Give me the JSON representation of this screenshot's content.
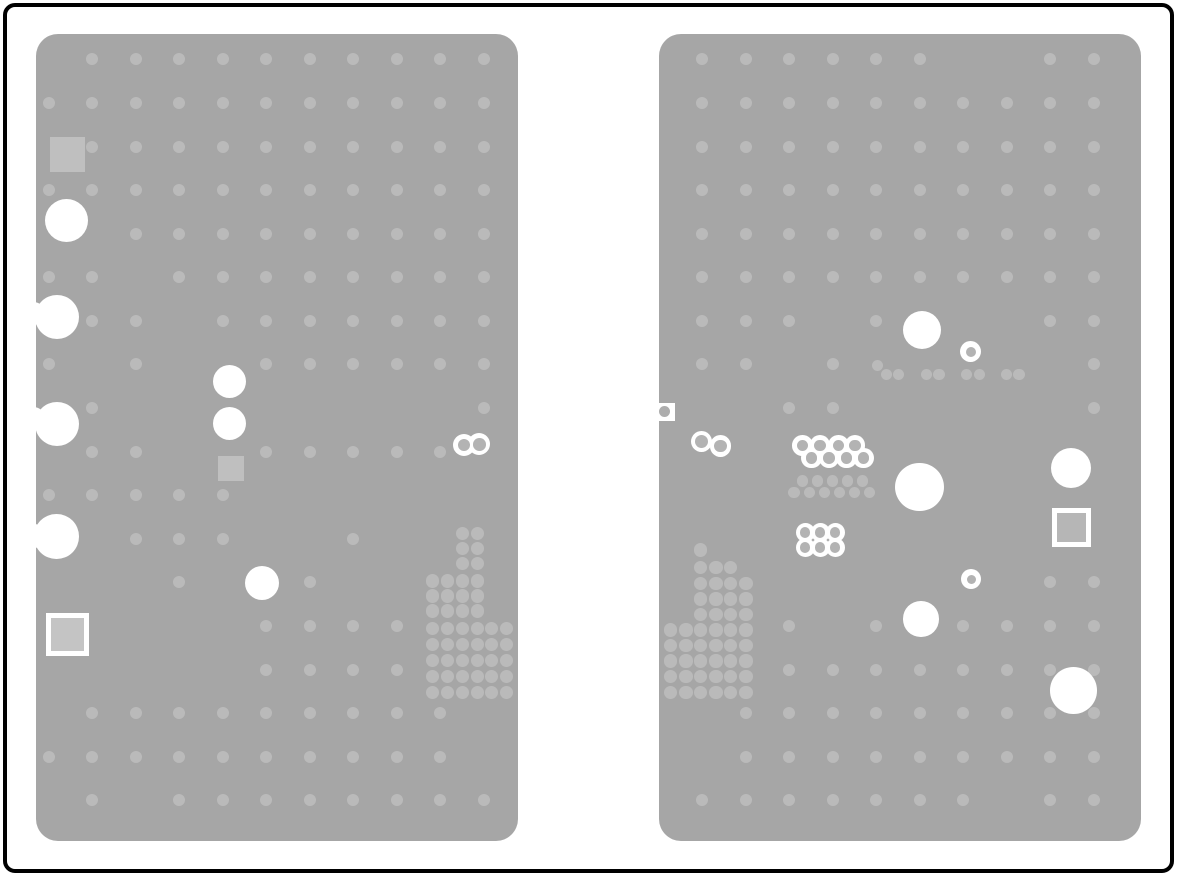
{
  "doc": {
    "kind": "pcb-plane-layer-image",
    "description": "Two gray PCB internal plane regions with thermal-relief via dots, drill clearances, pads and via rings"
  },
  "canvas": {
    "w": 1177,
    "h": 876,
    "bg": "#ffffff"
  },
  "frame": {
    "inset": 3,
    "stroke": "#000000",
    "stroke_w": 4,
    "radius": 12
  },
  "colors": {
    "panel": "#a6a6a6",
    "dot": "#bababa",
    "pad": "#bfbfbf",
    "pad_inner_left": "#c4c4c4",
    "pad_inner_right": "#b6b6b6",
    "white": "#ffffff",
    "ring_core": "#b3b3b3",
    "edge_dot": "#adadad"
  },
  "panels": [
    {
      "name": "pcb-plane-left",
      "rect": {
        "x": 36,
        "y": 34,
        "w": 482,
        "h": 807,
        "radius": 22
      },
      "grid": {
        "cols": [
          48.7,
          92.2,
          135.7,
          179.2,
          222.7,
          266.2,
          309.7,
          353.2,
          396.7,
          440.2,
          483.7
        ],
        "rows": [
          59.3,
          102.9,
          146.5,
          190.1,
          233.7,
          277.2,
          320.8,
          364.4,
          408.0,
          451.6,
          495.2,
          538.8,
          582.4,
          625.9,
          669.5,
          713.1,
          756.7,
          800.3
        ],
        "dot_r": 6,
        "rows_cols": [
          [
            1,
            2,
            3,
            4,
            5,
            6,
            7,
            8,
            9,
            10
          ],
          [
            0,
            1,
            2,
            3,
            4,
            5,
            6,
            7,
            8,
            9,
            10
          ],
          [
            1,
            2,
            3,
            4,
            5,
            6,
            7,
            8,
            9,
            10
          ],
          [
            0,
            1,
            2,
            3,
            4,
            5,
            6,
            7,
            8,
            9,
            10
          ],
          [
            2,
            3,
            4,
            5,
            6,
            7,
            8,
            9,
            10
          ],
          [
            0,
            1,
            3,
            4,
            5,
            6,
            7,
            8,
            9,
            10
          ],
          [
            1,
            2,
            4,
            5,
            6,
            7,
            8,
            9,
            10
          ],
          [
            0,
            2,
            5,
            6,
            7,
            8,
            9,
            10
          ],
          [
            1,
            10
          ],
          [
            1,
            2,
            5,
            6,
            7,
            8,
            9
          ],
          [
            0,
            1,
            2,
            3,
            4
          ],
          [
            2,
            3,
            4,
            7
          ],
          [
            3,
            6
          ],
          [
            5,
            6,
            7,
            8
          ],
          [
            5,
            6,
            7,
            8
          ],
          [
            1,
            2,
            3,
            4,
            5,
            6,
            7,
            8,
            9
          ],
          [
            0,
            1,
            2,
            3,
            4,
            5,
            6,
            7,
            8,
            9
          ],
          [
            1,
            3,
            4,
            5,
            6,
            7,
            8,
            9,
            10
          ]
        ]
      },
      "clusters": [
        {
          "cols": [
            432.9,
            447.7,
            462.5,
            477.2,
            491.8,
            506.4
          ],
          "rows": [
            533.3,
            548.7,
            563.7,
            581.0,
            596.0,
            611.0,
            628.8,
            644.8,
            660.4,
            676.2,
            692.4
          ],
          "dot_r": 6.6,
          "rows_cols": [
            [
              2,
              3
            ],
            [
              2,
              3
            ],
            [
              2,
              3
            ],
            [
              0,
              1,
              2,
              3
            ],
            [
              0,
              1,
              2,
              3
            ],
            [
              0,
              1,
              2,
              3
            ],
            [
              0,
              1,
              2,
              3,
              4,
              5
            ],
            [
              0,
              1,
              2,
              3,
              4,
              5
            ],
            [
              0,
              1,
              2,
              3,
              4,
              5
            ],
            [
              0,
              1,
              2,
              3,
              4,
              5
            ],
            [
              0,
              1,
              2,
              3,
              4,
              5
            ]
          ]
        }
      ],
      "extra_dots": [],
      "squares": [
        {
          "x": 49.5,
          "y": 136.5,
          "w": 35,
          "h": 35
        },
        {
          "x": 218.3,
          "y": 455.5,
          "w": 25.5,
          "h": 25
        }
      ],
      "bordered_squares": [
        {
          "x": 46,
          "y": 613,
          "w": 42.5,
          "h": 43,
          "bw": 5,
          "fill": "pad_inner_left"
        }
      ],
      "edge_squares": [],
      "white_circles": [
        {
          "x": 66.7,
          "y": 220.0,
          "r": 21.5
        },
        {
          "x": 56.7,
          "y": 317.0,
          "r": 22.0
        },
        {
          "x": 33.5,
          "y": 313.0,
          "r": 11.5
        },
        {
          "x": 56.7,
          "y": 423.5,
          "r": 22.0
        },
        {
          "x": 33.5,
          "y": 418.5,
          "r": 11.5
        },
        {
          "x": 56.3,
          "y": 536.5,
          "r": 22.3
        },
        {
          "x": 33.5,
          "y": 536.0,
          "r": 12.0
        },
        {
          "x": 229.7,
          "y": 381.7,
          "r": 16.7
        },
        {
          "x": 229.7,
          "y": 423.3,
          "r": 16.7
        },
        {
          "x": 261.9,
          "y": 582.8,
          "r": 17.2
        }
      ],
      "rings": [
        {
          "x": 464.0,
          "y": 445.0,
          "ro": 11,
          "ri": 6.3
        },
        {
          "x": 479.3,
          "y": 444.3,
          "ro": 11,
          "ri": 6.3
        }
      ]
    },
    {
      "name": "pcb-plane-right",
      "rect": {
        "x": 659,
        "y": 34,
        "w": 482,
        "h": 807,
        "radius": 22
      },
      "grid": {
        "cols": [
          702.3,
          745.8,
          789.3,
          832.8,
          876.3,
          919.8,
          963.3,
          1006.8,
          1050.3,
          1093.8
        ],
        "rows": [
          59.3,
          102.9,
          146.5,
          190.1,
          233.7,
          277.2,
          320.8,
          364.4,
          408.0,
          451.6,
          495.2,
          538.8,
          582.4,
          625.9,
          669.5,
          713.1,
          756.7,
          800.3
        ],
        "dot_r": 6,
        "rows_cols": [
          [
            0,
            1,
            2,
            3,
            4,
            5,
            8,
            9
          ],
          [
            0,
            1,
            2,
            3,
            4,
            5,
            6,
            7,
            8,
            9
          ],
          [
            0,
            1,
            2,
            3,
            4,
            5,
            6,
            7,
            8,
            9
          ],
          [
            0,
            1,
            2,
            3,
            4,
            5,
            6,
            7,
            8,
            9
          ],
          [
            0,
            1,
            2,
            3,
            4,
            5,
            6,
            7,
            8,
            9
          ],
          [
            0,
            1,
            2,
            3,
            4,
            5,
            6,
            7,
            8,
            9
          ],
          [
            0,
            1,
            2,
            4,
            8,
            9
          ],
          [
            0,
            1,
            3,
            9
          ],
          [
            2,
            3,
            9
          ],
          [],
          [],
          [],
          [
            8,
            9
          ],
          [
            2,
            4,
            6,
            7,
            8,
            9
          ],
          [
            2,
            3,
            4,
            5,
            6,
            7,
            8,
            9
          ],
          [
            1,
            2,
            3,
            4,
            5,
            6,
            7,
            8,
            9
          ],
          [
            1,
            2,
            3,
            4,
            5,
            6,
            7,
            8,
            9
          ],
          [
            0,
            1,
            2,
            3,
            4,
            5,
            6,
            8,
            9
          ]
        ]
      },
      "clusters": [
        {
          "cols": [
            670.7,
            686.0,
            700.7,
            716.0,
            730.7,
            746.0
          ],
          "rows": [
            550.0,
            567.7,
            583.3,
            599.0,
            614.3,
            630.0,
            645.7,
            661.0,
            676.7,
            692.3
          ],
          "dot_r": 6.6,
          "rows_cols": [
            [
              2
            ],
            [
              2,
              3,
              4
            ],
            [
              2,
              3,
              4,
              5
            ],
            [
              2,
              3,
              4,
              5
            ],
            [
              2,
              3,
              4,
              5
            ],
            [
              0,
              1,
              2,
              3,
              4,
              5
            ],
            [
              0,
              1,
              2,
              3,
              4,
              5
            ],
            [
              0,
              1,
              2,
              3,
              4,
              5
            ],
            [
              0,
              1,
              2,
              3,
              4,
              5
            ],
            [
              0,
              1,
              2,
              3,
              4,
              5
            ]
          ]
        }
      ],
      "extra_dots": [
        {
          "x": 877.7,
          "y": 365.3,
          "r": 5.7
        },
        {
          "x": 886.7,
          "y": 374.4,
          "r": 5.7
        },
        {
          "x": 898.3,
          "y": 374.4,
          "r": 5.7
        },
        {
          "x": 926.7,
          "y": 374.4,
          "r": 5.7
        },
        {
          "x": 939.0,
          "y": 374.4,
          "r": 5.7
        },
        {
          "x": 966.7,
          "y": 374.4,
          "r": 5.7
        },
        {
          "x": 979.3,
          "y": 374.4,
          "r": 5.7
        },
        {
          "x": 1006.7,
          "y": 374.4,
          "r": 5.7
        },
        {
          "x": 1019.0,
          "y": 374.4,
          "r": 5.7
        },
        {
          "x": 802.7,
          "y": 481.0,
          "r": 5.7
        },
        {
          "x": 817.3,
          "y": 481.0,
          "r": 5.7
        },
        {
          "x": 832.7,
          "y": 481.0,
          "r": 5.7
        },
        {
          "x": 847.7,
          "y": 481.0,
          "r": 5.7
        },
        {
          "x": 862.7,
          "y": 481.0,
          "r": 5.7
        },
        {
          "x": 794.0,
          "y": 492.7,
          "r": 5.7
        },
        {
          "x": 809.3,
          "y": 492.7,
          "r": 5.7
        },
        {
          "x": 824.3,
          "y": 492.7,
          "r": 5.7
        },
        {
          "x": 839.3,
          "y": 492.7,
          "r": 5.7
        },
        {
          "x": 854.3,
          "y": 492.7,
          "r": 5.7
        },
        {
          "x": 869.3,
          "y": 492.7,
          "r": 5.7
        }
      ],
      "squares": [],
      "bordered_squares": [
        {
          "x": 1051.7,
          "y": 507.7,
          "w": 39,
          "h": 39.6,
          "bw": 5,
          "fill": "pad_inner_right"
        }
      ],
      "edge_squares": [
        {
          "x": 657.0,
          "y": 403.0,
          "w": 18,
          "h": 17.5,
          "dot_r": 5.7
        }
      ],
      "white_circles": [
        {
          "x": 921.7,
          "y": 330.3,
          "r": 19.0
        },
        {
          "x": 919.3,
          "y": 487.0,
          "r": 24.3
        },
        {
          "x": 1071.2,
          "y": 467.6,
          "r": 20.0
        },
        {
          "x": 921.0,
          "y": 619.0,
          "r": 17.7
        },
        {
          "x": 1073.3,
          "y": 690.3,
          "r": 23.3
        }
      ],
      "rings": [
        {
          "x": 701.3,
          "y": 441.8,
          "ro": 10.7,
          "ri": 6.5
        },
        {
          "x": 720.7,
          "y": 446.0,
          "ro": 10.7,
          "ri": 6.3
        },
        {
          "x": 802.7,
          "y": 445.7,
          "ro": 10.3,
          "ri": 5.8
        },
        {
          "x": 820.0,
          "y": 445.7,
          "ro": 10.3,
          "ri": 5.8
        },
        {
          "x": 838.3,
          "y": 445.7,
          "ro": 10.3,
          "ri": 5.8
        },
        {
          "x": 855.0,
          "y": 445.7,
          "ro": 10.3,
          "ri": 5.8
        },
        {
          "x": 811.5,
          "y": 458.1,
          "ro": 10.3,
          "ri": 5.8
        },
        {
          "x": 829.0,
          "y": 458.1,
          "ro": 10.3,
          "ri": 5.8
        },
        {
          "x": 846.5,
          "y": 458.1,
          "ro": 10.3,
          "ri": 5.8
        },
        {
          "x": 863.6,
          "y": 458.1,
          "ro": 10.3,
          "ri": 5.8
        },
        {
          "x": 970.8,
          "y": 351.9,
          "ro": 10.5,
          "ri": 5.2
        },
        {
          "x": 971.0,
          "y": 579.2,
          "ro": 10.0,
          "ri": 4.5
        },
        {
          "x": 805.0,
          "y": 532.7,
          "ro": 9.5,
          "ri": 5.4
        },
        {
          "x": 820.0,
          "y": 532.7,
          "ro": 9.5,
          "ri": 5.4
        },
        {
          "x": 835.0,
          "y": 532.7,
          "ro": 9.5,
          "ri": 5.4
        },
        {
          "x": 805.0,
          "y": 547.2,
          "ro": 9.5,
          "ri": 5.4
        },
        {
          "x": 820.0,
          "y": 547.2,
          "ro": 9.5,
          "ri": 5.4
        },
        {
          "x": 835.0,
          "y": 547.2,
          "ro": 9.5,
          "ri": 5.4
        }
      ]
    }
  ]
}
